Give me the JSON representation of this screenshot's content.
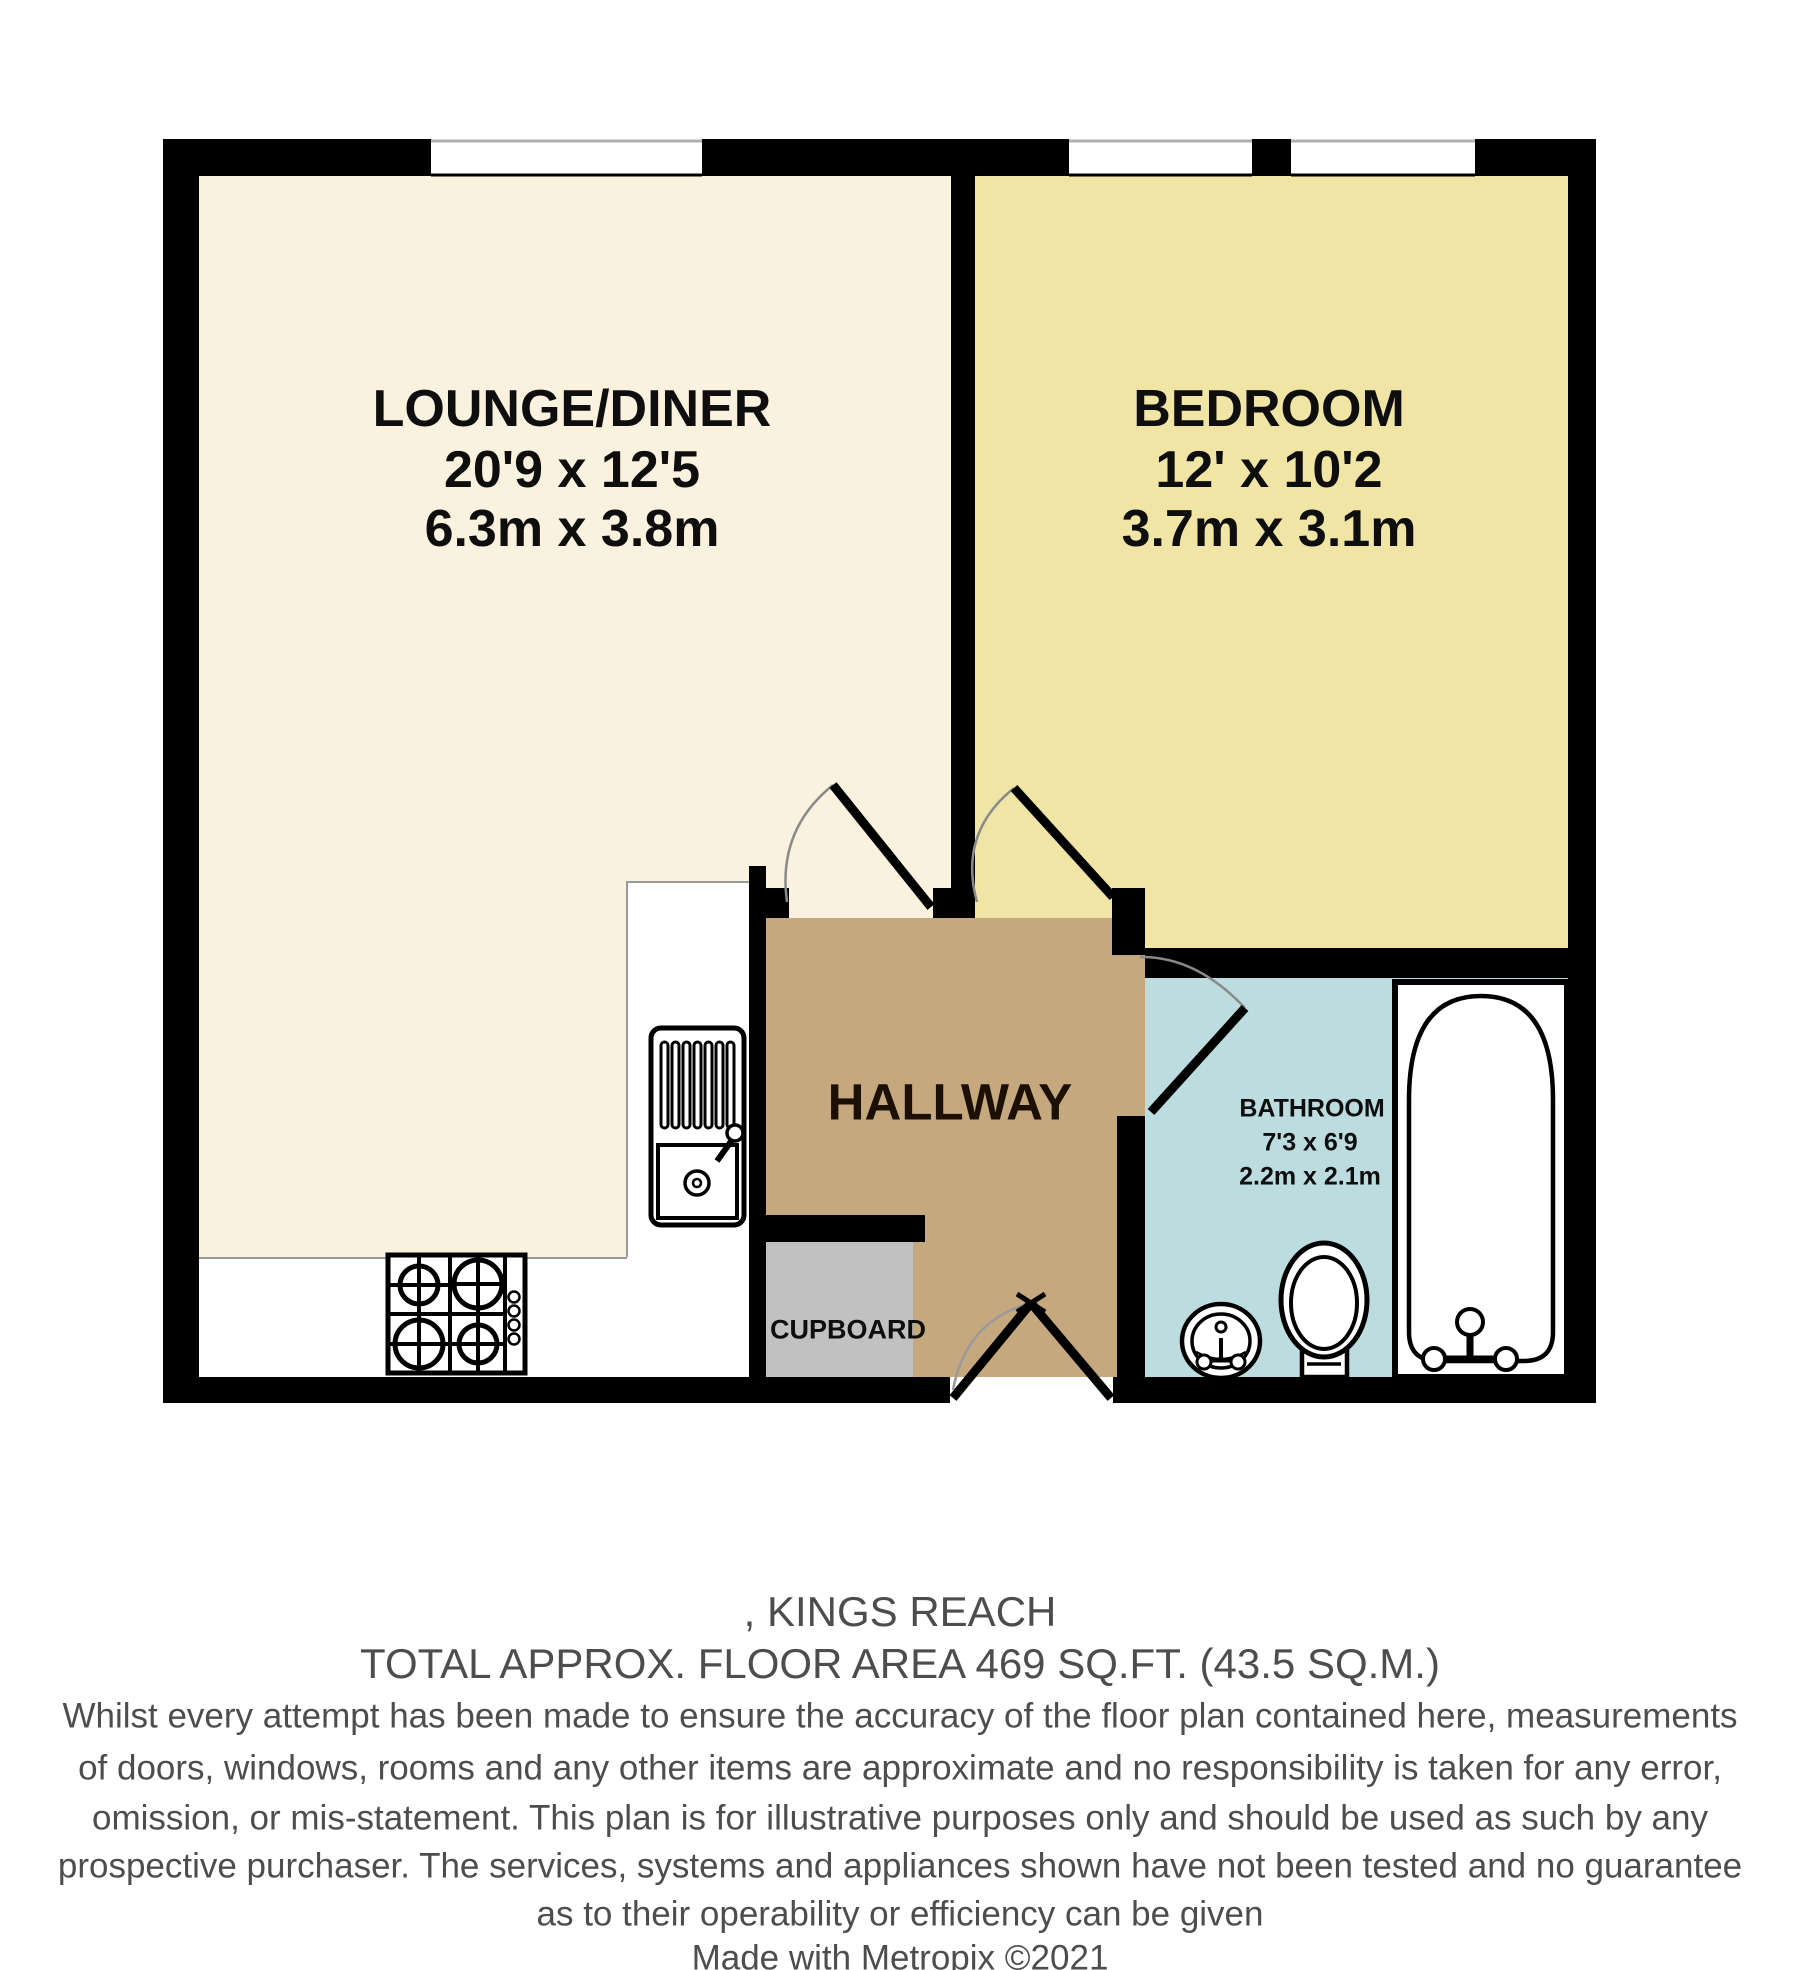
{
  "plan": {
    "type": "floorplan",
    "wall_color": "#000000",
    "door_arc_color": "#8a8a8a",
    "window_color": "#ffffff",
    "label_color": "#0e0e0e",
    "rooms": {
      "lounge": {
        "name": "LOUNGE/DINER",
        "size_imperial": "20'9 x 12'5",
        "size_metric": "6.3m x 3.8m",
        "fill": "#FAF1DE"
      },
      "bedroom": {
        "name": "BEDROOM",
        "size_imperial": "12' x 10'2",
        "size_metric": "3.7m x 3.1m",
        "fill": "#F1E5A5"
      },
      "hallway": {
        "name": "HALLWAY",
        "fill": "#C6A87E"
      },
      "bathroom": {
        "name": "BATHROOM",
        "size_imperial": "7'3 x 6'9",
        "size_metric": "2.2m x 2.1m",
        "fill": "#BCDCE0"
      },
      "cupboard": {
        "name": "CUPBOARD",
        "fill": "#C1C1C1"
      },
      "kitchen_area_fill": "#FFFFFF"
    },
    "fixtures": [
      "kitchen-sink-unit",
      "gas-hob",
      "bath",
      "toilet",
      "wash-basin"
    ],
    "windows_count": 3,
    "doors_count": 4
  },
  "footer": {
    "address_line": ", KINGS REACH",
    "area_line": "TOTAL APPROX. FLOOR AREA 469 SQ.FT. (43.5 SQ.M.)",
    "disclaimer_lines": [
      "Whilst every attempt has been made to ensure the accuracy of the floor plan contained here, measurements",
      "of doors, windows, rooms and any other items are approximate and no responsibility is taken for any error,",
      "omission, or mis-statement. This plan is for illustrative purposes only and should be used as such by any",
      "prospective purchaser. The services, systems and appliances shown have not been tested and no guarantee",
      "as to their operability or efficiency can be given"
    ],
    "credit_line": "Made with Metropix ©2021",
    "text_color": "#4d4d4d"
  }
}
